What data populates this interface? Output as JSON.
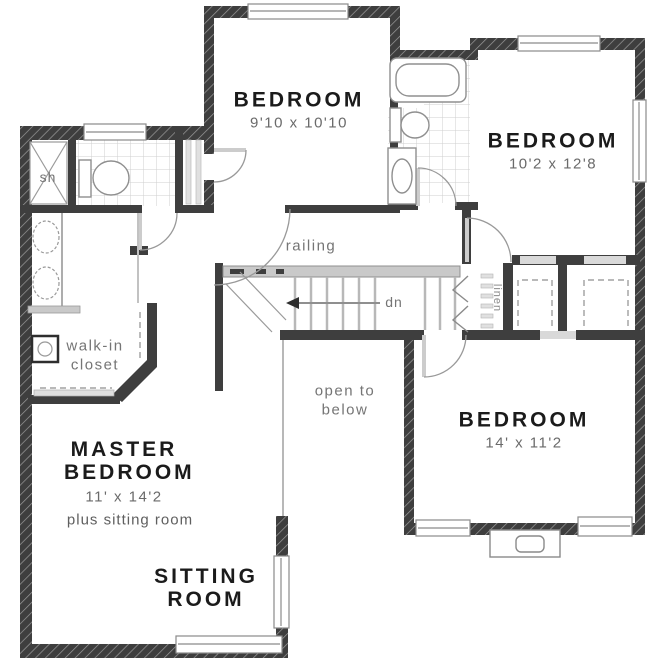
{
  "colors": {
    "wall": "#3e3e3e",
    "fixture_gray": "#c9c9c9",
    "tile_gray": "#d8d8d8",
    "room_label": "#1b1b1b",
    "annotation_gray": "#6e6e6e",
    "background": "#ffffff"
  },
  "rooms": {
    "bedroom_top": {
      "name": "BEDROOM",
      "dims": "9'10 x 10'10"
    },
    "bedroom_right": {
      "name": "BEDROOM",
      "dims": "10'2 x 12'8"
    },
    "bedroom_bottom_right": {
      "name": "BEDROOM",
      "dims": "14' x 11'2"
    },
    "master_bedroom": {
      "name": "MASTER BEDROOM",
      "dims": "11' x 14'2",
      "note": "plus sitting room"
    },
    "sitting_room": {
      "name": "SITTING ROOM"
    },
    "walk_in_closet": {
      "name": "walk-in closet"
    }
  },
  "annotations": {
    "railing": "railing",
    "down": "dn",
    "open_to_below": "open to below",
    "shower": "sh",
    "linen": "linen"
  }
}
